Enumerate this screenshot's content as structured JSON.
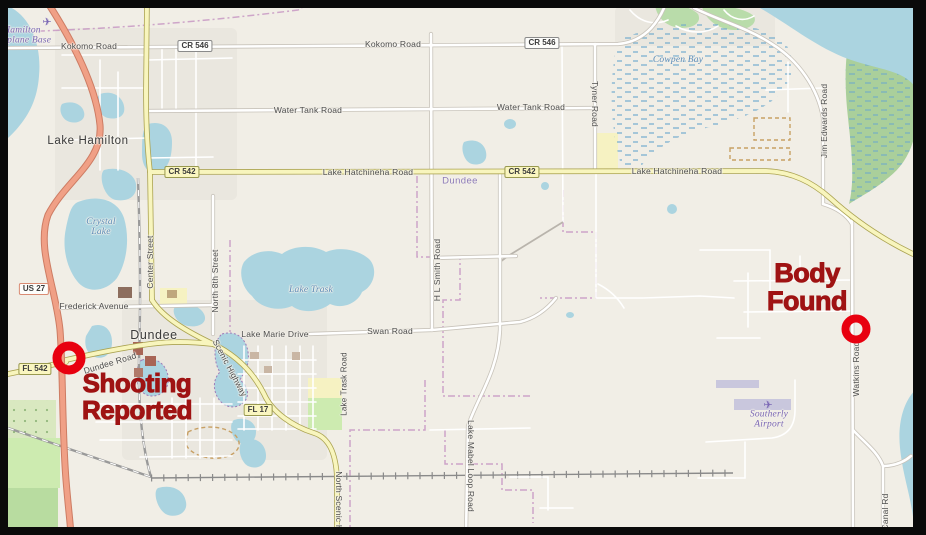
{
  "incident_annotations": {
    "text_color": "#9f1313",
    "marker_color": "#e8000f",
    "shooting": {
      "line1": "Shooting",
      "line2": "Reported"
    },
    "body": {
      "line1": "Body",
      "line2": "Found"
    }
  },
  "places": {
    "lake_hamilton": "Lake Hamilton",
    "dundee": "Dundee",
    "dundee_area": "Dundee"
  },
  "water_labels": {
    "crystal_lake": "Crystal Lake",
    "lake_trask": "Lake Trask",
    "cowpen_bay": "Cowpen Bay"
  },
  "pois": {
    "seaplane_base": "Hamilton Seaplane Base",
    "airport": "Southerly Airport"
  },
  "shields": {
    "us27": "US 27",
    "fl542": "FL 542",
    "fl17": "FL 17",
    "cr546": "CR 546",
    "cr542": "CR 542"
  },
  "roads": {
    "kokomo": "Kokomo Road",
    "water_tank": "Water Tank Road",
    "lake_hatchineha": "Lake Hatchineha Road",
    "tyner": "Tyner Road",
    "jim_edwards": "Jim Edwards Road",
    "watkins": "Watkins Road",
    "canal": "Canal Rd",
    "hl_smith": "H L Smith Road",
    "center_street": "Center Street",
    "north_8th": "North 8th Street",
    "frederick": "Frederick Avenue",
    "lake_marie": "Lake Marie Drive",
    "swan": "Swan Road",
    "dundee_road": "Dundee Road",
    "scenic": "Scenic Highway",
    "north_scenic": "North Scenic Highway",
    "lake_trask_road": "Lake Trask Road",
    "lake_mabel": "Lake Mabel Loop Road"
  }
}
